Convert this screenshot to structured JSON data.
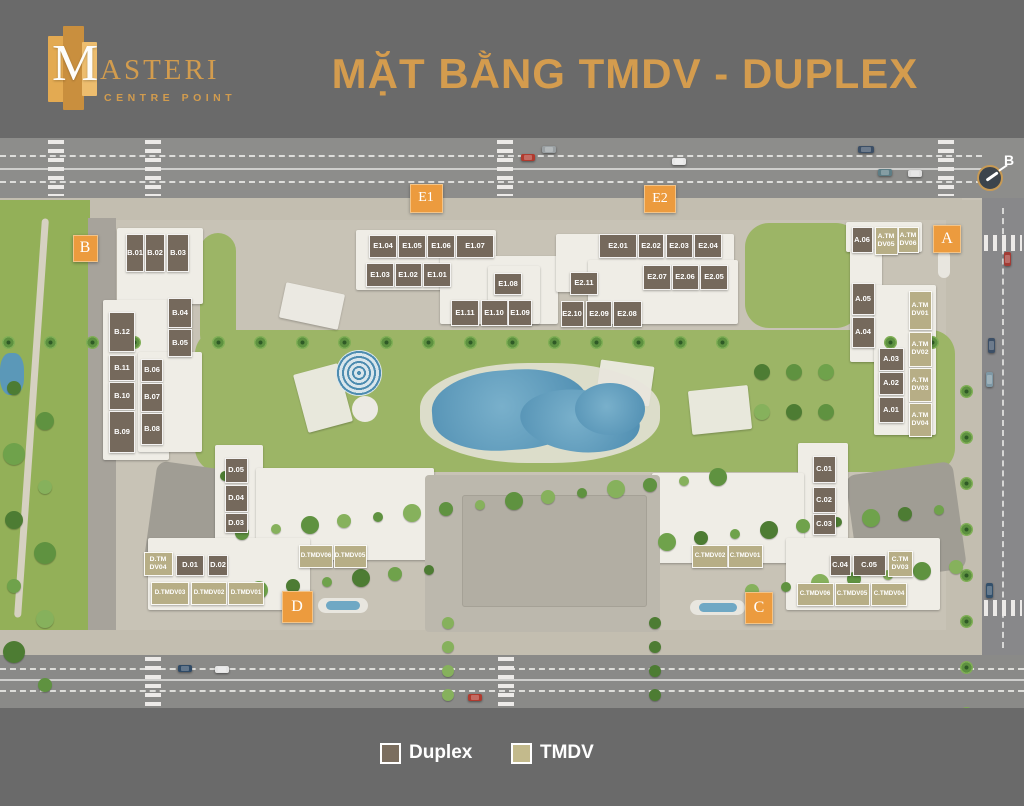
{
  "header": {
    "logo": {
      "m": "M",
      "rest": "ASTERI",
      "subtitle": "CENTRE POINT"
    },
    "title": "MẶT BẰNG TMDV - DUPLEX"
  },
  "map": {
    "north_label": "B",
    "colors": {
      "badge_orange": "#ec9b3e",
      "duplex": "#75695c",
      "tmdv": "#b7ae86",
      "pool_blue": "#5796ba"
    },
    "badges": [
      {
        "label": "B",
        "x": 85,
        "y": 248,
        "w": 25,
        "h": 27
      },
      {
        "label": "E1",
        "x": 426,
        "y": 198,
        "w": 33,
        "h": 29
      },
      {
        "label": "E2",
        "x": 660,
        "y": 199,
        "w": 32,
        "h": 28
      },
      {
        "label": "A",
        "x": 947,
        "y": 239,
        "w": 28,
        "h": 28
      },
      {
        "label": "D",
        "x": 297,
        "y": 607,
        "w": 31,
        "h": 32
      },
      {
        "label": "C",
        "x": 759,
        "y": 608,
        "w": 28,
        "h": 32
      }
    ],
    "units": [
      {
        "label": "B.01",
        "type": "d",
        "x": 135,
        "y": 253,
        "w": 18,
        "h": 38
      },
      {
        "label": "B.02",
        "type": "d",
        "x": 155,
        "y": 253,
        "w": 20,
        "h": 38
      },
      {
        "label": "B.03",
        "type": "d",
        "x": 178,
        "y": 253,
        "w": 22,
        "h": 38
      },
      {
        "label": "B.04",
        "type": "d",
        "x": 180,
        "y": 313,
        "w": 24,
        "h": 30
      },
      {
        "label": "B.05",
        "type": "d",
        "x": 180,
        "y": 343,
        "w": 24,
        "h": 28
      },
      {
        "label": "B.12",
        "type": "d",
        "x": 122,
        "y": 332,
        "w": 26,
        "h": 40
      },
      {
        "label": "B.11",
        "type": "d",
        "x": 122,
        "y": 368,
        "w": 26,
        "h": 26
      },
      {
        "label": "B.10",
        "type": "d",
        "x": 122,
        "y": 396,
        "w": 26,
        "h": 28
      },
      {
        "label": "B.09",
        "type": "d",
        "x": 122,
        "y": 432,
        "w": 26,
        "h": 42
      },
      {
        "label": "B.06",
        "type": "d",
        "x": 152,
        "y": 370,
        "w": 22,
        "h": 23
      },
      {
        "label": "B.07",
        "type": "d",
        "x": 152,
        "y": 397,
        "w": 22,
        "h": 29
      },
      {
        "label": "B.08",
        "type": "d",
        "x": 152,
        "y": 429,
        "w": 22,
        "h": 32
      },
      {
        "label": "E1.04",
        "type": "d",
        "x": 383,
        "y": 246,
        "w": 28,
        "h": 23
      },
      {
        "label": "E1.05",
        "type": "d",
        "x": 412,
        "y": 246,
        "w": 28,
        "h": 23
      },
      {
        "label": "E1.06",
        "type": "d",
        "x": 441,
        "y": 246,
        "w": 28,
        "h": 23
      },
      {
        "label": "E1.07",
        "type": "d",
        "x": 475,
        "y": 246,
        "w": 38,
        "h": 23
      },
      {
        "label": "E1.03",
        "type": "d",
        "x": 380,
        "y": 275,
        "w": 28,
        "h": 24
      },
      {
        "label": "E1.02",
        "type": "d",
        "x": 408,
        "y": 275,
        "w": 27,
        "h": 24
      },
      {
        "label": "E1.01",
        "type": "d",
        "x": 437,
        "y": 275,
        "w": 28,
        "h": 24
      },
      {
        "label": "E1.08",
        "type": "d",
        "x": 508,
        "y": 284,
        "w": 28,
        "h": 22
      },
      {
        "label": "E1.11",
        "type": "d",
        "x": 465,
        "y": 313,
        "w": 28,
        "h": 26
      },
      {
        "label": "E1.10",
        "type": "d",
        "x": 494,
        "y": 313,
        "w": 27,
        "h": 26
      },
      {
        "label": "E1.09",
        "type": "d",
        "x": 520,
        "y": 313,
        "w": 24,
        "h": 26
      },
      {
        "label": "E2.01",
        "type": "d",
        "x": 618,
        "y": 246,
        "w": 38,
        "h": 24
      },
      {
        "label": "E2.02",
        "type": "d",
        "x": 651,
        "y": 246,
        "w": 26,
        "h": 24
      },
      {
        "label": "E2.03",
        "type": "d",
        "x": 679,
        "y": 246,
        "w": 27,
        "h": 24
      },
      {
        "label": "E2.04",
        "type": "d",
        "x": 708,
        "y": 246,
        "w": 28,
        "h": 24
      },
      {
        "label": "E2.07",
        "type": "d",
        "x": 657,
        "y": 277,
        "w": 28,
        "h": 25
      },
      {
        "label": "E2.06",
        "type": "d",
        "x": 685,
        "y": 277,
        "w": 27,
        "h": 25
      },
      {
        "label": "E2.05",
        "type": "d",
        "x": 714,
        "y": 277,
        "w": 28,
        "h": 25
      },
      {
        "label": "E2.11",
        "type": "d",
        "x": 584,
        "y": 283,
        "w": 28,
        "h": 23
      },
      {
        "label": "E2.10",
        "type": "d",
        "x": 572,
        "y": 314,
        "w": 23,
        "h": 26
      },
      {
        "label": "E2.09",
        "type": "d",
        "x": 599,
        "y": 314,
        "w": 26,
        "h": 26
      },
      {
        "label": "E2.08",
        "type": "d",
        "x": 627,
        "y": 314,
        "w": 29,
        "h": 26
      },
      {
        "label": "A.06",
        "type": "d",
        "x": 862,
        "y": 240,
        "w": 21,
        "h": 26
      },
      {
        "label": "A.TM\nDV05",
        "type": "t",
        "x": 886,
        "y": 241,
        "w": 23,
        "h": 28
      },
      {
        "label": "A.TM\nDV06",
        "type": "t",
        "x": 908,
        "y": 240,
        "w": 21,
        "h": 26
      },
      {
        "label": "A.05",
        "type": "d",
        "x": 863,
        "y": 299,
        "w": 23,
        "h": 32
      },
      {
        "label": "A.04",
        "type": "d",
        "x": 863,
        "y": 332,
        "w": 23,
        "h": 31
      },
      {
        "label": "A.TM\nDV01",
        "type": "t",
        "x": 920,
        "y": 310,
        "w": 23,
        "h": 39
      },
      {
        "label": "A.TM\nDV02",
        "type": "t",
        "x": 920,
        "y": 349,
        "w": 23,
        "h": 35
      },
      {
        "label": "A.03",
        "type": "d",
        "x": 891,
        "y": 359,
        "w": 25,
        "h": 23
      },
      {
        "label": "A.02",
        "type": "d",
        "x": 891,
        "y": 383,
        "w": 25,
        "h": 23
      },
      {
        "label": "A.01",
        "type": "d",
        "x": 891,
        "y": 410,
        "w": 25,
        "h": 26
      },
      {
        "label": "A.TM\nDV03",
        "type": "t",
        "x": 920,
        "y": 385,
        "w": 23,
        "h": 34
      },
      {
        "label": "A.TM\nDV04",
        "type": "t",
        "x": 920,
        "y": 420,
        "w": 23,
        "h": 34
      },
      {
        "label": "D.05",
        "type": "d",
        "x": 236,
        "y": 470,
        "w": 23,
        "h": 25
      },
      {
        "label": "D.04",
        "type": "d",
        "x": 236,
        "y": 498,
        "w": 23,
        "h": 27
      },
      {
        "label": "D.03",
        "type": "d",
        "x": 236,
        "y": 523,
        "w": 23,
        "h": 20
      },
      {
        "label": "D.TM\nDV04",
        "type": "t",
        "x": 158,
        "y": 564,
        "w": 29,
        "h": 24
      },
      {
        "label": "D.01",
        "type": "d",
        "x": 190,
        "y": 565,
        "w": 28,
        "h": 21
      },
      {
        "label": "D.02",
        "type": "d",
        "x": 218,
        "y": 565,
        "w": 20,
        "h": 21
      },
      {
        "label": "D.TMDV06",
        "type": "t",
        "x": 316,
        "y": 556,
        "w": 34,
        "h": 23
      },
      {
        "label": "D.TMDV05",
        "type": "t",
        "x": 350,
        "y": 556,
        "w": 33,
        "h": 23
      },
      {
        "label": "D.TMDV03",
        "type": "t",
        "x": 170,
        "y": 593,
        "w": 38,
        "h": 23
      },
      {
        "label": "D.TMDV02",
        "type": "t",
        "x": 209,
        "y": 593,
        "w": 36,
        "h": 23
      },
      {
        "label": "D.TMDV01",
        "type": "t",
        "x": 246,
        "y": 593,
        "w": 36,
        "h": 23
      },
      {
        "label": "C.01",
        "type": "d",
        "x": 824,
        "y": 469,
        "w": 23,
        "h": 27
      },
      {
        "label": "C.02",
        "type": "d",
        "x": 824,
        "y": 500,
        "w": 23,
        "h": 26
      },
      {
        "label": "C.03",
        "type": "d",
        "x": 824,
        "y": 524,
        "w": 23,
        "h": 21
      },
      {
        "label": "C.TMDV02",
        "type": "t",
        "x": 710,
        "y": 556,
        "w": 36,
        "h": 23
      },
      {
        "label": "C.TMDV01",
        "type": "t",
        "x": 745,
        "y": 556,
        "w": 35,
        "h": 23
      },
      {
        "label": "C.04",
        "type": "d",
        "x": 840,
        "y": 565,
        "w": 21,
        "h": 21
      },
      {
        "label": "C.05",
        "type": "d",
        "x": 869,
        "y": 565,
        "w": 33,
        "h": 21
      },
      {
        "label": "C.TM\nDV03",
        "type": "t",
        "x": 900,
        "y": 564,
        "w": 25,
        "h": 26
      },
      {
        "label": "C.TMDV06",
        "type": "t",
        "x": 815,
        "y": 594,
        "w": 37,
        "h": 23
      },
      {
        "label": "C.TMDV05",
        "type": "t",
        "x": 852,
        "y": 594,
        "w": 35,
        "h": 23
      },
      {
        "label": "C.TMDV04",
        "type": "t",
        "x": 889,
        "y": 594,
        "w": 36,
        "h": 23
      }
    ]
  },
  "legend": {
    "items": [
      {
        "label": "Duplex",
        "type": "duplex",
        "color": "#7b6e5f"
      },
      {
        "label": "TMDV",
        "type": "tmdv",
        "color": "#c3ba8c"
      }
    ]
  }
}
